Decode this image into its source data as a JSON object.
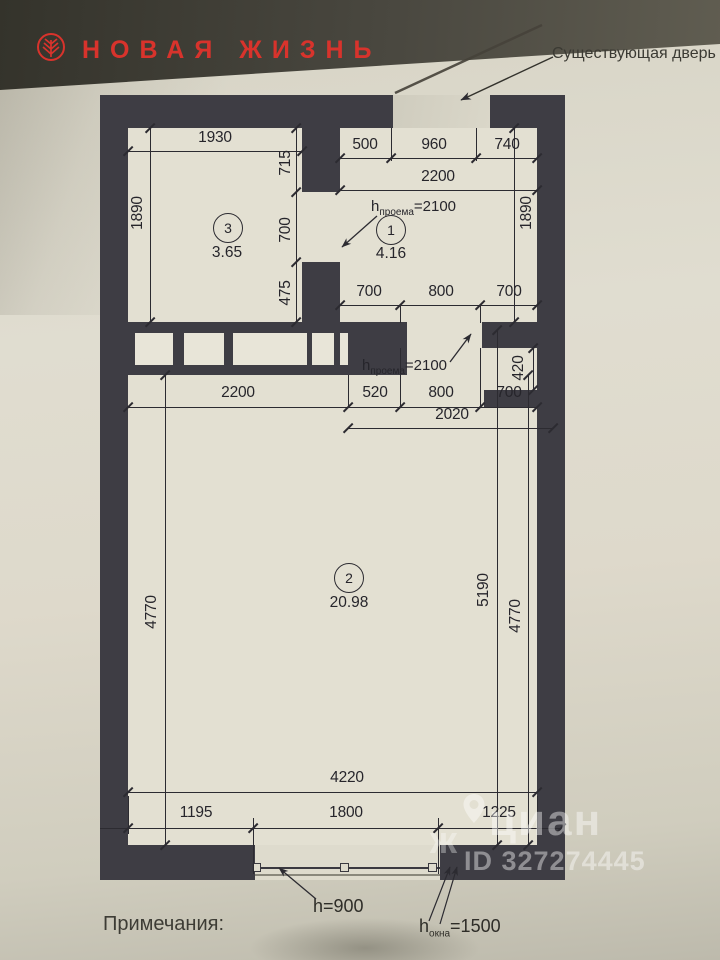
{
  "header": {
    "logo_text": "НОВАЯ ЖИЗНЬ",
    "logo_color": "#d8332c",
    "door_note": "Существующая дверь h"
  },
  "rooms": [
    {
      "number": "1",
      "area": "4.16"
    },
    {
      "number": "2",
      "area": "20.98"
    },
    {
      "number": "3",
      "area": "3.65"
    }
  ],
  "dims": {
    "room3_width": "1930",
    "room3_height": "1890",
    "mid_chain": [
      "715",
      "700",
      "475"
    ],
    "room1_top": [
      "500",
      "960",
      "740"
    ],
    "room1_width": "2200",
    "room1_height": "1890",
    "room1_bottom": [
      "700",
      "800",
      "700"
    ],
    "hall_width": "2200",
    "niche_chain": [
      "520",
      "800",
      "700"
    ],
    "niche_total": "2020",
    "niche_depth": "420",
    "room2_left": "4770",
    "room2_inner": "5190",
    "room2_right": "4770",
    "bottom_total": "4220",
    "bottom_chain": [
      "1195",
      "1800",
      "1225"
    ]
  },
  "openings": {
    "door1": {
      "prefix": "h",
      "sub": "проема",
      "value": "=2100"
    },
    "door2": {
      "prefix": "h",
      "sub": "проема",
      "value": "=2100"
    },
    "window_sill": "h=900",
    "window": {
      "prefix": "h",
      "sub": "окна",
      "value": "=1500"
    }
  },
  "footer": {
    "notes_label": "Примечания:"
  },
  "watermark": {
    "brand": "циан",
    "id_text": "ID 327274445",
    "partial_glyph": "ж"
  }
}
